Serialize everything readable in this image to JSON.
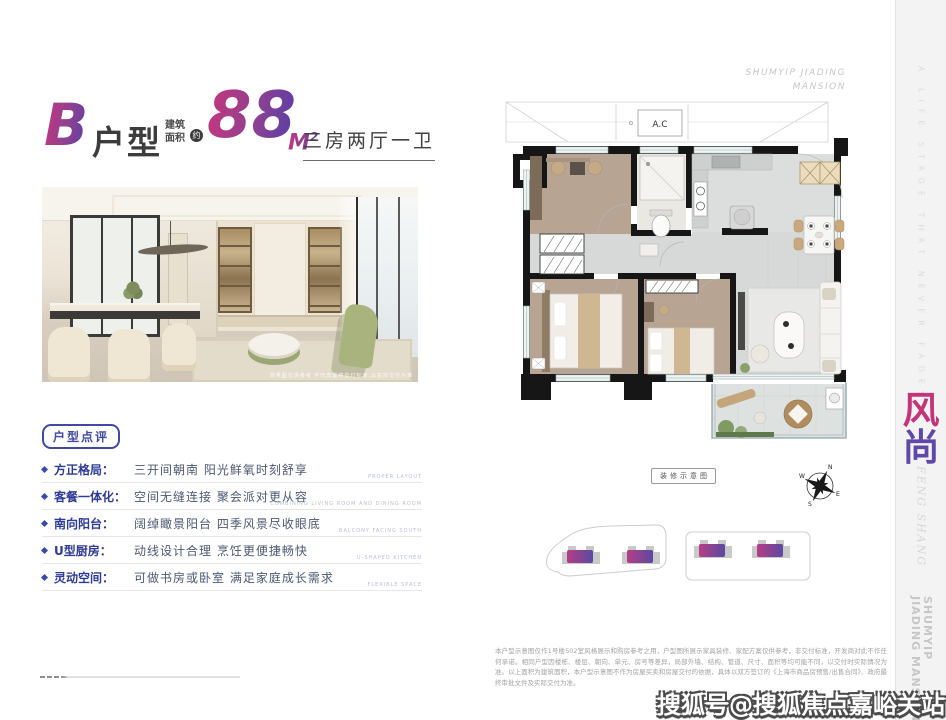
{
  "header": {
    "unit_letter": "B",
    "unit_suffix": "户型",
    "area_label_line1": "建筑",
    "area_label_line2": "面积",
    "area_approx": "约",
    "area_value": "88",
    "area_unit": "M",
    "area_unit_sup": "2",
    "layout_text": "三房两厅一卫"
  },
  "photo": {
    "caption": "效果图仅供参考 不代表最终交付标准 以实际交付为准"
  },
  "review": {
    "badge": "户型点评",
    "items": [
      {
        "label": "方正格局：",
        "desc": "三开间朝南 阳光鲜氧时刻舒享",
        "en": "PROPER LAYOUT"
      },
      {
        "label": "客餐一体化：",
        "desc": "空间无缝连接 聚会派对更从容",
        "en": "COMBINING LIVING ROOM AND DINING ROOM"
      },
      {
        "label": "南向阳台：",
        "desc": "阔绰瞰景阳台 四季风景尽收眼底",
        "en": "BALCONY FACING SOUTH"
      },
      {
        "label": "U型厨房：",
        "desc": "动线设计合理 烹饪更便捷畅快",
        "en": "U-SHAPED KITCHEN"
      },
      {
        "label": "灵动空间：",
        "desc": "可做书房或卧室 满足家庭成长需求",
        "en": "FLEXIBLE SPACE"
      }
    ]
  },
  "plan": {
    "brand_line1": "SHUMYIP JIADING",
    "brand_line2": "MANSION",
    "ac_label": "A.C",
    "schematic_label": "装修示意图",
    "compass": {
      "n": "N",
      "e": "E",
      "s": "S",
      "w": "W"
    }
  },
  "disclaimer": "本户型示意图仅作1号楼502室风格展示和购房参考之用，户型图所展示家具装修、家配方案仅供参考，非交付标准，开发商对此不作任何承诺。相同户型因楼栋、楼层、朝向、单元、房号等差异，局部外墙、结构、管道、尺寸、面积等均可能不同，以交付时实际情况为准。以上面积为建筑面积，本户型示意图不作为房屋买卖和房屋交付的依据，具体以双方签订的《上海市商品房预售/出售合同》、政府最终审批文件及实际交付为准。",
  "side_strip": {
    "tagline": "A LIFE STAGE THAT NEVER FADES",
    "brand_cn_1": "风",
    "brand_cn_2": "尚",
    "brand_en_1": "FENG",
    "brand_en_2": "SHANG",
    "brand_vert_1": "SHUMYIP JIADING",
    "brand_vert_2": "MANSION"
  },
  "watermark": "搜狐号@搜狐焦点嘉峪关站",
  "colors": {
    "accent_pink": "#c2377e",
    "accent_purple": "#5b3fa5",
    "label_blue": "#2e3b94",
    "strip_bg": "#f3f3f3",
    "wall_black": "#161616",
    "wood_floor": "#b7a493",
    "tile_gray": "#d7d9d8"
  }
}
